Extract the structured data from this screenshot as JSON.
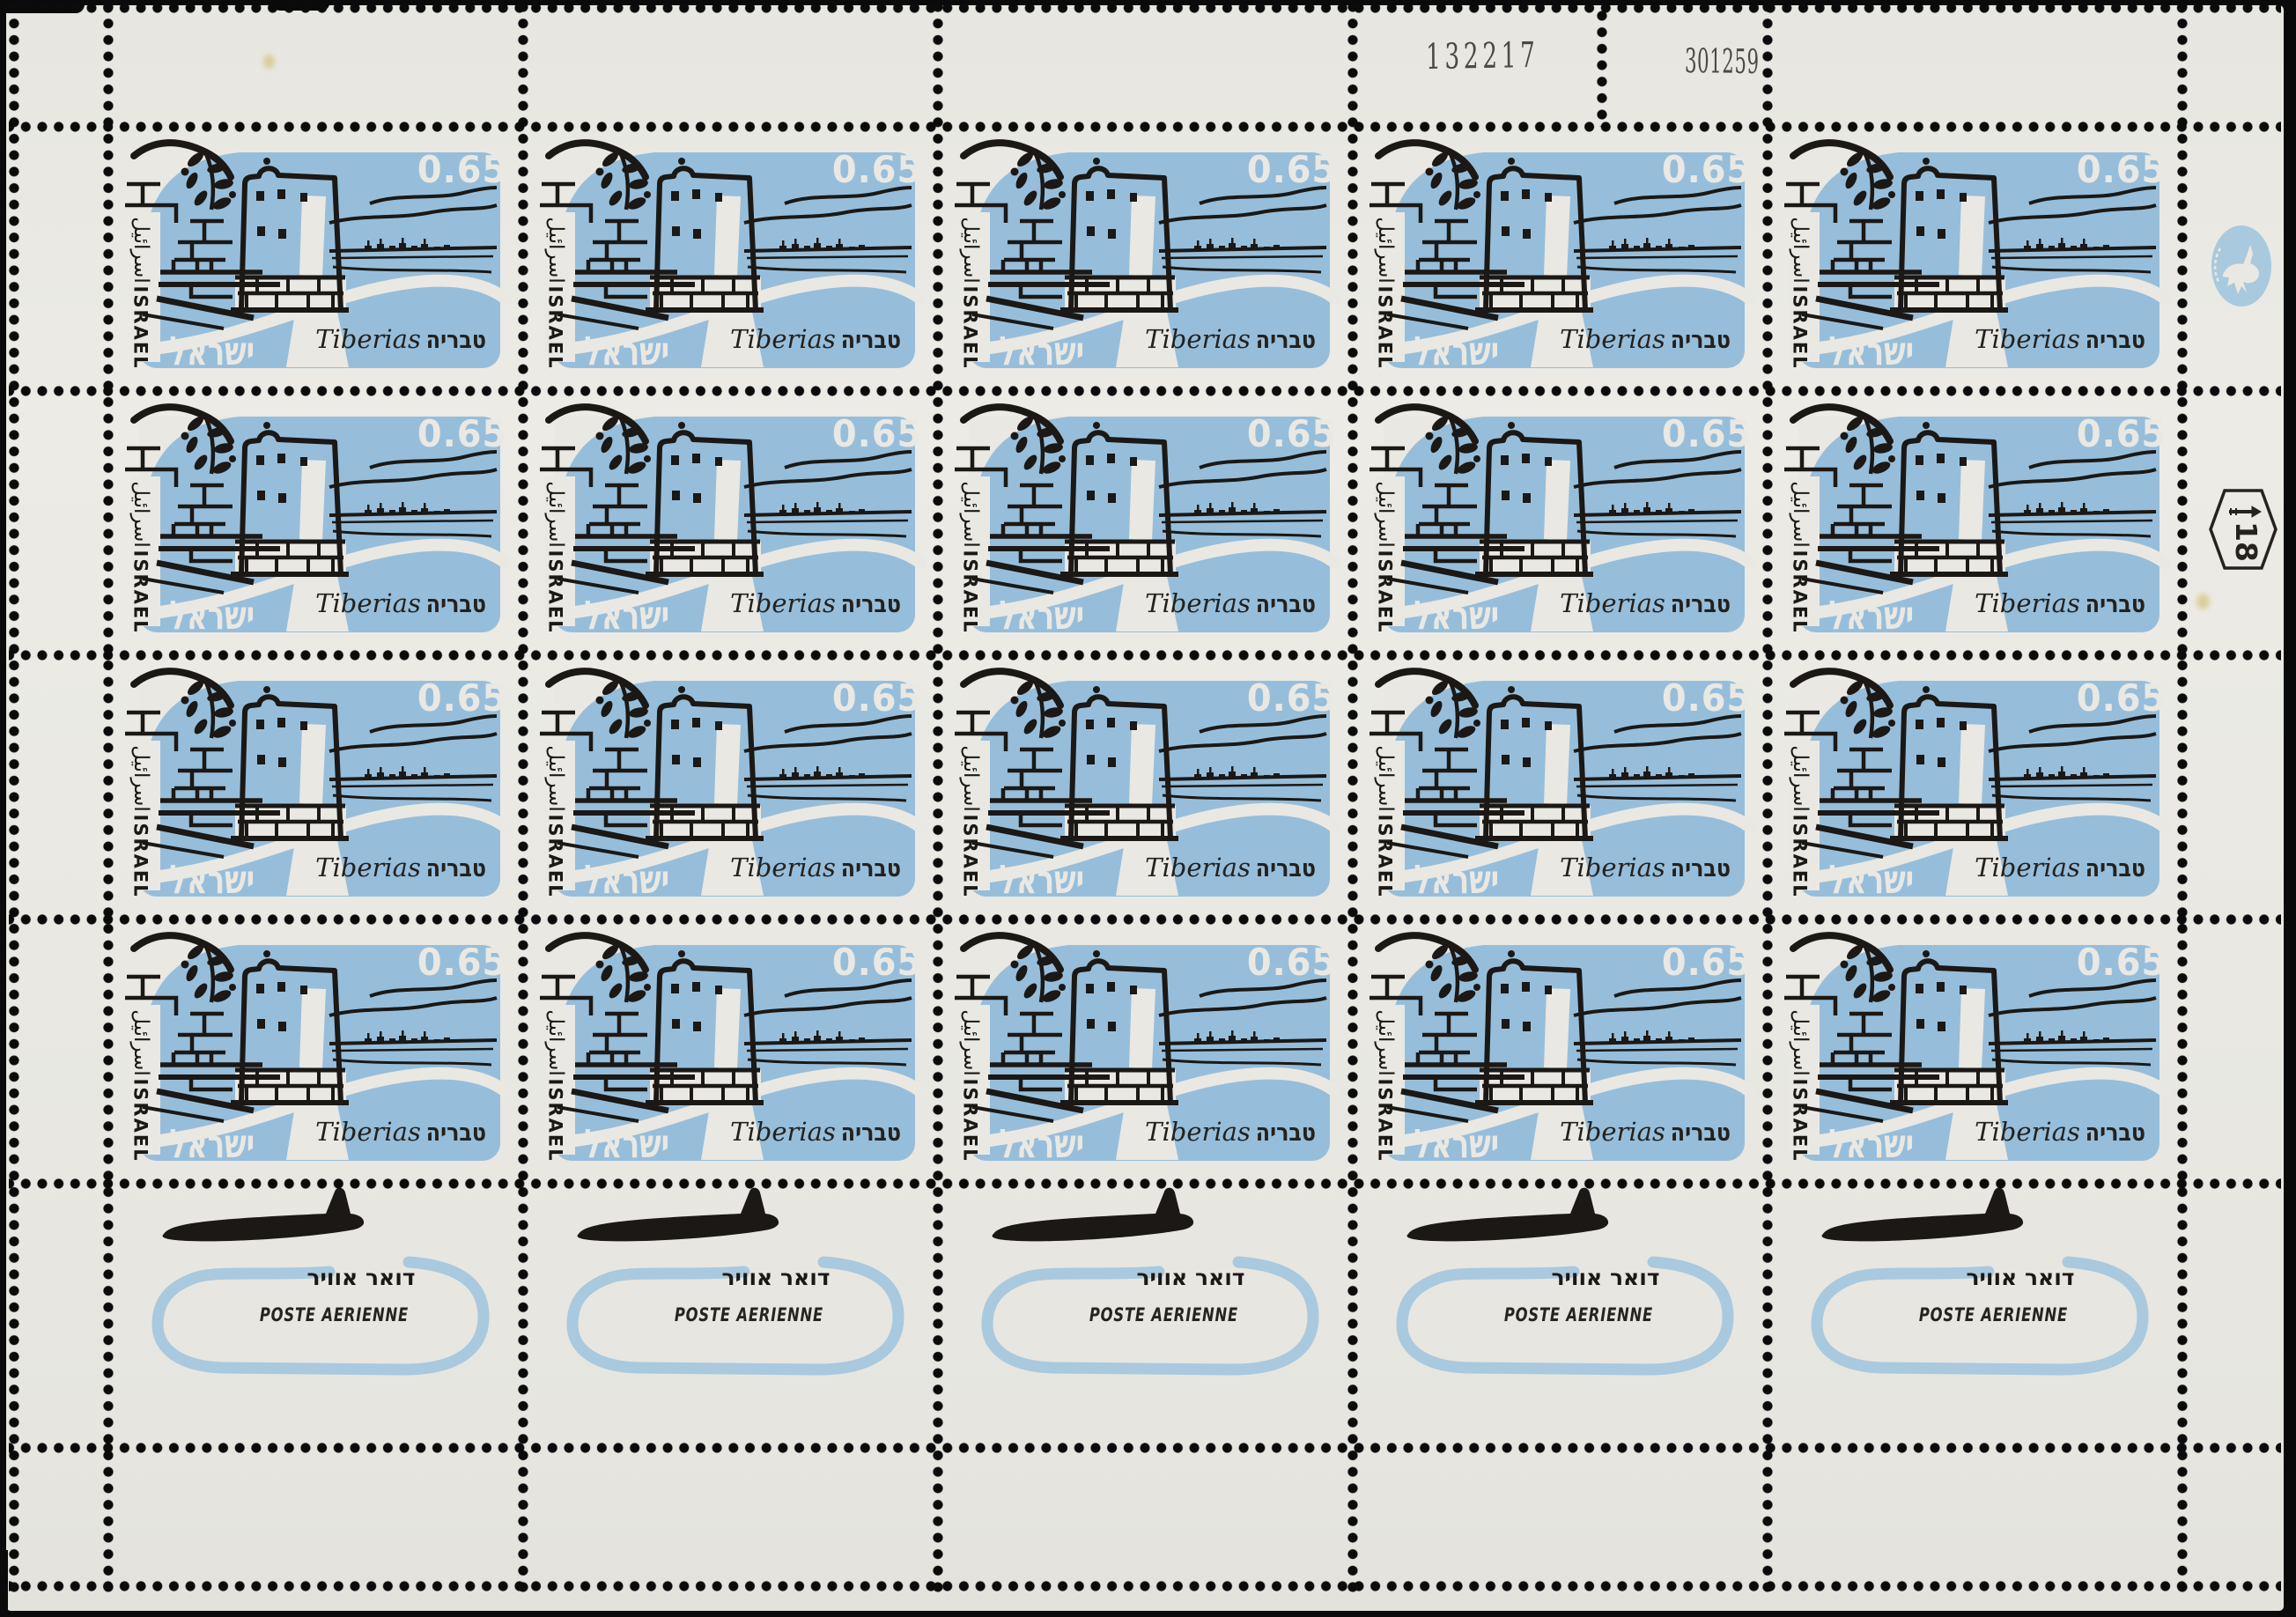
{
  "selvage": {
    "serial_number": "132217",
    "date_number": "301259",
    "plate_number": "18",
    "logo": "israel-postal-deer-emblem"
  },
  "stamp": {
    "denomination": "0.65",
    "country_latin": "ISRAEL",
    "country_arabic": "اسرائيل",
    "country_hebrew": "ישראל",
    "place_latin": "Tiberias",
    "place_hebrew": "טבריה",
    "rows": 4,
    "columns": 5,
    "count": 20
  },
  "tab": {
    "airmail_hebrew": "דואר אוויר",
    "airmail_french": "POSTE AERIENNE",
    "count": 5
  },
  "colors": {
    "stamp_blue": "#96bedb",
    "tab_blue": "#a9c9de",
    "paper": "#eae8e2",
    "ink": "#1b1815"
  }
}
